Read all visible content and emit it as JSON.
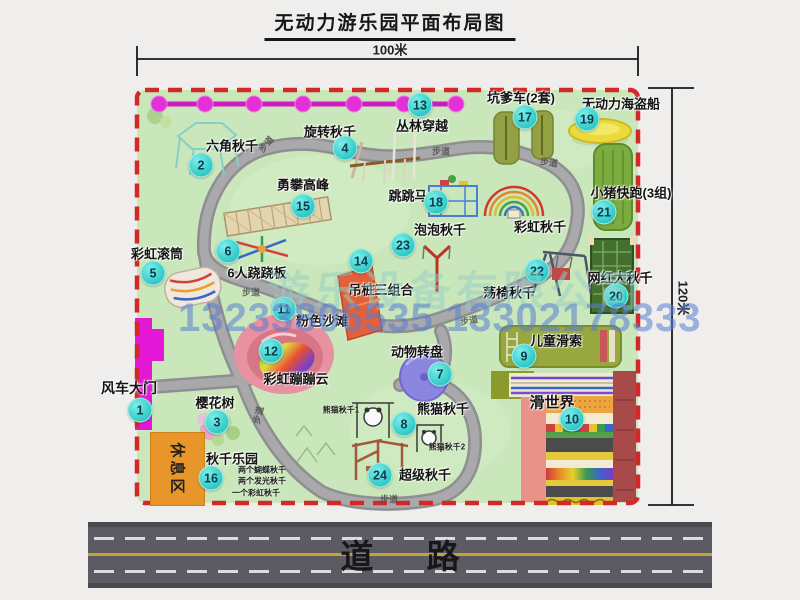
{
  "title": "无动力游乐园平面布局图",
  "dimensions": {
    "width_label": "100米",
    "height_label": "120米"
  },
  "road": {
    "label": "道 路"
  },
  "rest_area": {
    "label": "休息区"
  },
  "watermark": {
    "company": "游乐设备有限公司",
    "phone": "13233806535 13302178333"
  },
  "trail_label_text": "步道",
  "trail_labels": [
    {
      "x": 266,
      "y": 144,
      "rot": -50
    },
    {
      "x": 441,
      "y": 151,
      "rot": 0
    },
    {
      "x": 549,
      "y": 162,
      "rot": 8
    },
    {
      "x": 251,
      "y": 292,
      "rot": 0
    },
    {
      "x": 469,
      "y": 320,
      "rot": -10
    },
    {
      "x": 258,
      "y": 415,
      "rot": -75
    },
    {
      "x": 389,
      "y": 499,
      "rot": 0
    }
  ],
  "attractions": [
    {
      "no": 1,
      "slug": "windmill-gate",
      "name": "风车大门",
      "label": {
        "x": 129,
        "y": 388,
        "size": 14
      },
      "marker": {
        "x": 140,
        "y": 410
      }
    },
    {
      "no": 2,
      "slug": "hexagon-swing",
      "name": "六角秋千",
      "label": {
        "x": 232,
        "y": 145
      },
      "marker": {
        "x": 201,
        "y": 165
      }
    },
    {
      "no": 3,
      "slug": "cherry-tree",
      "name": "樱花树",
      "label": {
        "x": 215,
        "y": 402
      },
      "marker": {
        "x": 217,
        "y": 422
      }
    },
    {
      "no": 4,
      "slug": "rotating-swing",
      "name": "旋转秋千",
      "label": {
        "x": 330,
        "y": 131
      },
      "marker": {
        "x": 345,
        "y": 148
      }
    },
    {
      "no": 5,
      "slug": "rainbow-roller",
      "name": "彩虹滚筒",
      "label": {
        "x": 157,
        "y": 253
      },
      "marker": {
        "x": 153,
        "y": 273
      }
    },
    {
      "no": 6,
      "slug": "six-person-seesaw",
      "name": "6人跷跷板",
      "label": {
        "x": 257,
        "y": 272
      },
      "marker": {
        "x": 228,
        "y": 251
      }
    },
    {
      "no": 7,
      "slug": "animal-carousel",
      "name": "动物转盘",
      "label": {
        "x": 417,
        "y": 351
      },
      "marker": {
        "x": 440,
        "y": 374
      }
    },
    {
      "no": 8,
      "slug": "panda-swing",
      "name": "熊猫秋千",
      "label": {
        "x": 443,
        "y": 408
      },
      "marker": {
        "x": 404,
        "y": 424
      },
      "notes": [
        {
          "text": "熊猫秋千1",
          "x": 341,
          "y": 410
        },
        {
          "text": "熊猫秋千2",
          "x": 447,
          "y": 447
        }
      ]
    },
    {
      "no": 9,
      "slug": "kids-zipline",
      "name": "儿童滑索",
      "label": {
        "x": 556,
        "y": 340
      },
      "marker": {
        "x": 524,
        "y": 356
      }
    },
    {
      "no": 10,
      "slug": "slide-world",
      "name": "滑世界",
      "label": {
        "x": 552,
        "y": 402,
        "size": 15
      },
      "marker": {
        "x": 572,
        "y": 419
      }
    },
    {
      "no": 11,
      "slug": "pink-beach",
      "name": "粉色沙滩",
      "label": {
        "x": 322,
        "y": 320
      },
      "marker": {
        "x": 284,
        "y": 309
      }
    },
    {
      "no": 12,
      "slug": "rainbow-bounce-cloud",
      "name": "彩虹蹦蹦云",
      "label": {
        "x": 296,
        "y": 378
      },
      "marker": {
        "x": 271,
        "y": 351
      }
    },
    {
      "no": 13,
      "slug": "jungle-crossing",
      "name": "丛林穿越",
      "label": {
        "x": 422,
        "y": 125
      },
      "marker": {
        "x": 420,
        "y": 105
      }
    },
    {
      "no": 14,
      "slug": "hanging-post-combo",
      "name": "吊桩三组合",
      "label": {
        "x": 381,
        "y": 289
      },
      "marker": {
        "x": 361,
        "y": 261
      }
    },
    {
      "no": 15,
      "slug": "peak-climbing",
      "name": "勇攀高峰",
      "label": {
        "x": 303,
        "y": 184
      },
      "marker": {
        "x": 303,
        "y": 206
      }
    },
    {
      "no": 16,
      "slug": "swing-park",
      "name": "秋千乐园",
      "label": {
        "x": 232,
        "y": 458
      },
      "marker": {
        "x": 211,
        "y": 478
      },
      "notes": [
        {
          "text": "两个蝴蝶秋千",
          "x": 262,
          "y": 470
        },
        {
          "text": "两个发光秋千",
          "x": 262,
          "y": 481
        },
        {
          "text": "一个彩虹秋千",
          "x": 256,
          "y": 493
        }
      ]
    },
    {
      "no": 17,
      "slug": "kengdie-car",
      "name": "坑爹车(2套)",
      "label": {
        "x": 521,
        "y": 97
      },
      "marker": {
        "x": 525,
        "y": 117
      }
    },
    {
      "no": 18,
      "slug": "jumping-horse",
      "name": "跳跳马",
      "label": {
        "x": 408,
        "y": 195
      },
      "marker": {
        "x": 436,
        "y": 202
      }
    },
    {
      "no": 19,
      "slug": "pirate-ship",
      "name": "无动力海盗船",
      "label": {
        "x": 621,
        "y": 103
      },
      "marker": {
        "x": 587,
        "y": 119
      }
    },
    {
      "no": 20,
      "slug": "big-net-swing",
      "name": "网红大秋千",
      "label": {
        "x": 620,
        "y": 277
      },
      "marker": {
        "x": 616,
        "y": 296
      }
    },
    {
      "no": 21,
      "slug": "piggy-run",
      "name": "小猪快跑(3组)",
      "label": {
        "x": 631,
        "y": 192
      },
      "marker": {
        "x": 604,
        "y": 212
      }
    },
    {
      "no": 22,
      "slug": "swing-chair",
      "name": "荡椅秋千",
      "label": {
        "x": 509,
        "y": 292
      },
      "marker": {
        "x": 537,
        "y": 271
      }
    },
    {
      "no": 23,
      "slug": "bubble-swing",
      "name": "泡泡秋千",
      "label": {
        "x": 440,
        "y": 229
      },
      "marker": {
        "x": 403,
        "y": 245
      }
    },
    {
      "no": 24,
      "slug": "super-swing",
      "name": "超级秋千",
      "label": {
        "x": 425,
        "y": 474
      },
      "marker": {
        "x": 380,
        "y": 475
      }
    },
    {
      "no": null,
      "slug": "rainbow-swing",
      "name": "彩虹秋千",
      "label": {
        "x": 540,
        "y": 226
      },
      "marker": null
    }
  ],
  "colors": {
    "park_green": "#c9e7ba",
    "trail_gray": "#8f8f92",
    "border_red": "#d22828",
    "gate_magenta": "#e318d6",
    "marker_cyan": "#2ec9c5",
    "road_gray": "#5c5b63",
    "road_yellow": "#c2a336"
  }
}
